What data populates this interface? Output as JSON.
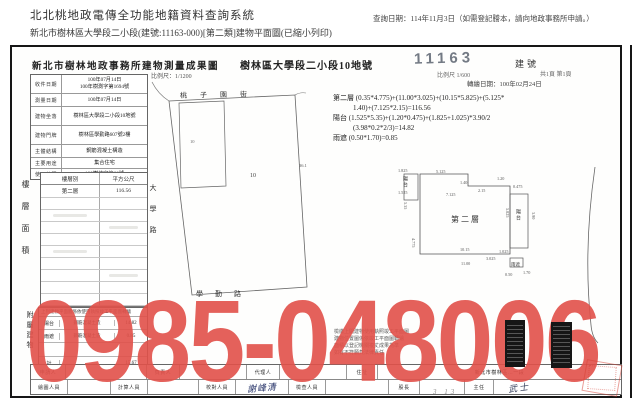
{
  "page": {
    "system_title": "北北桃地政電傳全功能地籍資料查詢系統",
    "query_note": "查詢日期：114年11月3日（如需登記謄本，請向地政事務所申請。）",
    "subtitle": "新北市樹林區大學段二小段(建號:11163-000)[第二類]建物平面圖(已縮小列印)"
  },
  "doc": {
    "title": "新北市樹林地政事務所建物測量成果圖",
    "parcel_title": "樹林區大學段二小段10地號",
    "building_no_stamp": "11163",
    "building_no_label": "建號",
    "scale_note_small": "比例尺 1/600",
    "page_note": "共1頁 第1頁",
    "redraw_date": "轉繪日期：100年02月24日",
    "site_scale": "比例尺：1/1200",
    "info": {
      "rows": [
        {
          "label": "收件日期",
          "value": "100年07月14日",
          "value2": "100年樹測字第1694號"
        },
        {
          "label": "測量日期",
          "value": "100年07月14日"
        },
        {
          "label": "建物坐落",
          "value": "樹林區大學段二小段10地號"
        },
        {
          "label": "建物門牌",
          "value": "樹林區學勤路607號2樓"
        },
        {
          "label": "主體結構",
          "value": "鋼筋混凝土構造"
        },
        {
          "label": "主要用途",
          "value": "集合住宅"
        },
        {
          "label": "使用執照",
          "value": "100樹使字第66號"
        }
      ]
    },
    "area_table": {
      "side_label": "樓層面積",
      "col1": "樓層別",
      "col2": "平方公尺",
      "floor": "第二層",
      "floor_area": "116.56",
      "total_label": "合 計",
      "total": "116.56"
    },
    "annex": {
      "side_label": "附屬建物",
      "note": "上列建物平面圖係依使用執照竣工平面圖轉繪",
      "rows": [
        {
          "name": "陽台",
          "material": "鋼筋混凝土造",
          "area": "14.82"
        },
        {
          "name": "雨遮",
          "material": "鋼筋混凝土造",
          "area": "0.85"
        },
        {
          "name": "計",
          "material": "",
          "area": "15.67"
        }
      ]
    },
    "calc": {
      "line1": "第二層 (0.35*4.775)+(11.00*3.025)+(10.15*5.825)+(5.125*",
      "line2": "1.40)+(7.125*2.15)=116.56",
      "line3": "陽台 (1.525*5.35)+(1.20*0.475)+(1.825+1.025)*3.90/2",
      "line4": "(3.98*0.2*2/3)=14.82",
      "line5": "雨遮 (0.50*1.70)=0.85"
    },
    "site_plan": {
      "street_top": "桃子園街",
      "street_left": "大學路",
      "street_bottom": "學勤路",
      "parcel_no": "10",
      "inner_no": "10",
      "dim": "36.1"
    },
    "floor_plan": {
      "room": "第二層",
      "balcony_left": "陽台",
      "balcony_right": "陽台",
      "canopy": "雨遮",
      "dims": [
        "1.825",
        "5.125",
        "1.20",
        "2.15",
        "7.125",
        "1.40",
        "0.475",
        "5.825",
        "5.35",
        "4.775",
        "10.15",
        "11.00",
        "1.025",
        "3.90",
        "0.50",
        "1.70",
        "1.525",
        "3.025"
      ]
    },
    "fine_print": [
      "檢繳上開建物使用執照竣工平面圖",
      "建物位置圖係依竣工平面圖轉繪",
      "面積以登記機關複丈成果為準",
      "如有不符願負法律責任"
    ],
    "footer": {
      "row1": [
        {
          "label": "申請人",
          "value": ""
        },
        {
          "label": "負責人",
          "value": ""
        },
        {
          "label": "代理人",
          "value": ""
        },
        {
          "label": "住址",
          "value": "新北市樹林區…一段"
        }
      ],
      "row2": [
        {
          "label": "繪圖人員",
          "value": ""
        },
        {
          "label": "計算人員",
          "value": ""
        },
        {
          "label": "校對人員",
          "value": "謝峰清"
        },
        {
          "label": "檢查人員",
          "value": ""
        },
        {
          "label": "股長",
          "value": ""
        },
        {
          "label": "主任",
          "value": "武士"
        }
      ],
      "pencil_note": "3 13"
    },
    "watermark": {
      "text": "0985-048006",
      "color": "#e2514a"
    }
  }
}
